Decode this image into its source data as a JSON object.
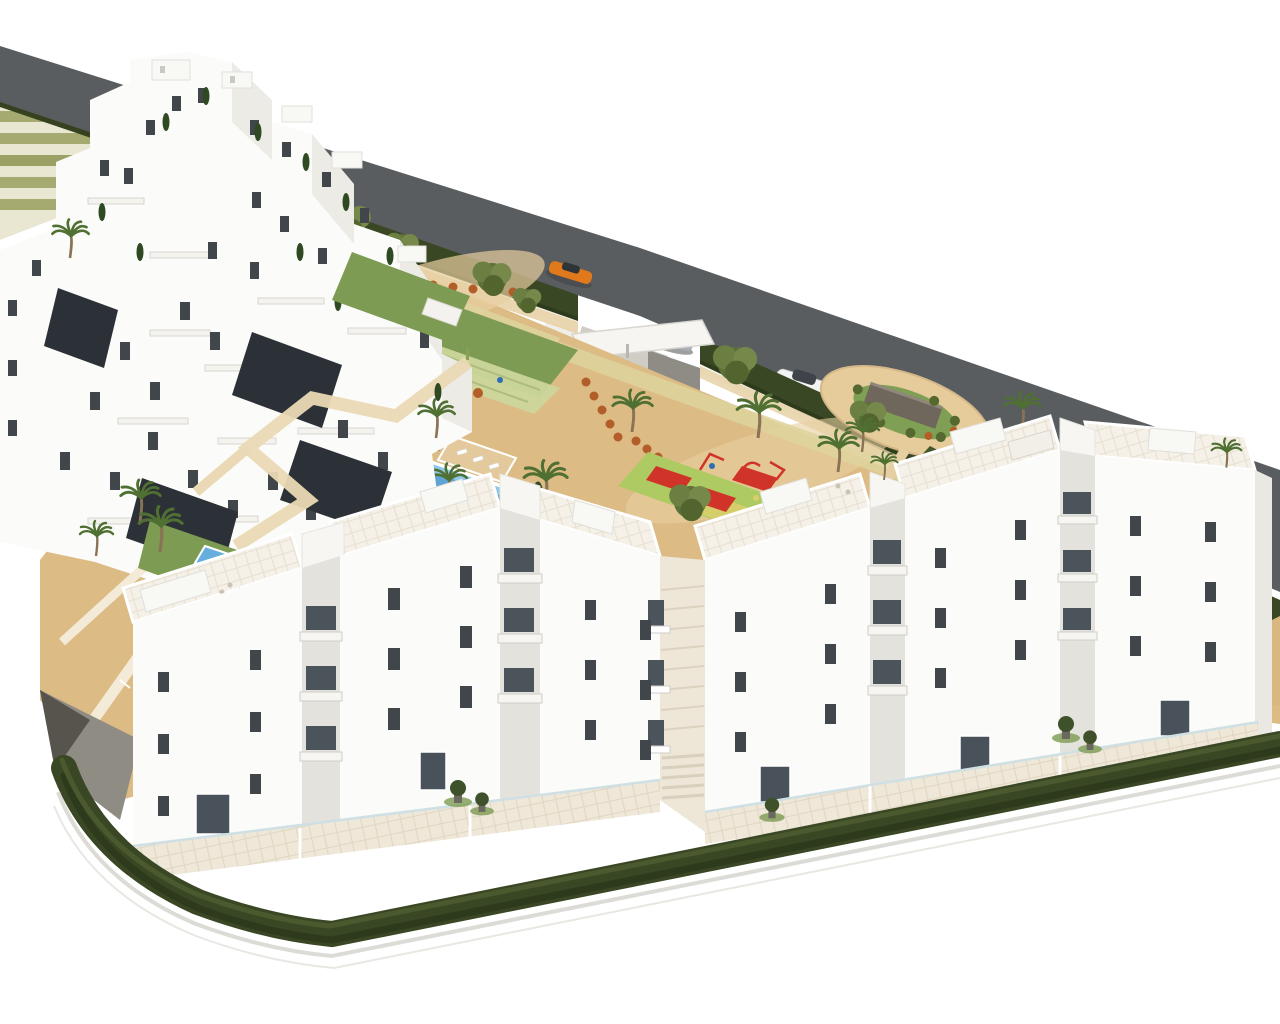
{
  "scene": {
    "kind": "architectural-3d-render",
    "view": "aerial-oblique",
    "subject": "white-apartment-complex-with-gardens-pool-playground-and-road"
  },
  "colors": {
    "background": "#ffffff",
    "road_asphalt": "#595d5f",
    "road_edge_wall": "#b9b7b0",
    "terrace_step_light": "#e9e6d2",
    "terrace_step_green": "#a4aa70",
    "hedge_dark": "#3a4724",
    "hedge_shadow": "#2e3a1c",
    "lawn_green": "#7d9b52",
    "court_green": "#ccd69c",
    "sand_ground": "#ddbb85",
    "sand_light": "#e8cf9f",
    "path_cream": "#ead9b4",
    "pool_water": "#8ec7e8",
    "pool_deep": "#4e97cf",
    "deck_sand": "#e3c99b",
    "plaza_sand": "#e6cb9b",
    "feature_wall_gray": "#6f675c",
    "playground_mat": "#aecb63",
    "playground_red": "#d03428",
    "playground_yellow": "#d8cf6a",
    "shrub_orange": "#b35d28",
    "tree_green": "#5d7038",
    "cypress_green": "#2f4a23",
    "palm_green": "#4f7032",
    "building_white": "#fbfbf9",
    "building_shade": "#ecebe6",
    "window_dark": "#40464a",
    "glass_dark": "#4b545b",
    "gravel_dark": "#2b3136",
    "slope_gray": "#8e8c83",
    "curb_light": "#dcdbd5",
    "car_orange": "#e0791c",
    "car_silver": "#a7adb2",
    "car_white": "#f2f3f2",
    "canopy_white": "#f6f5f1",
    "driveway_gray": "#cfcdc6",
    "purple_tree": "#8a6b7a"
  },
  "objects": {
    "cars": [
      {
        "name": "sports-car",
        "color_name": "orange"
      },
      {
        "name": "sedan",
        "color_name": "silver"
      },
      {
        "name": "suv",
        "color_name": "white"
      }
    ],
    "amenities": [
      "swimming-pool",
      "kids-pool",
      "sun-deck-island",
      "pergola",
      "circular-plaza-with-feature-wall",
      "playground",
      "sports-court",
      "landscaped-gardens",
      "palm-trees",
      "perimeter-hedges"
    ],
    "buildings": {
      "hillside_terraced_cluster": 1,
      "front_row_blocks": 6,
      "storeys_visible": 4
    }
  }
}
